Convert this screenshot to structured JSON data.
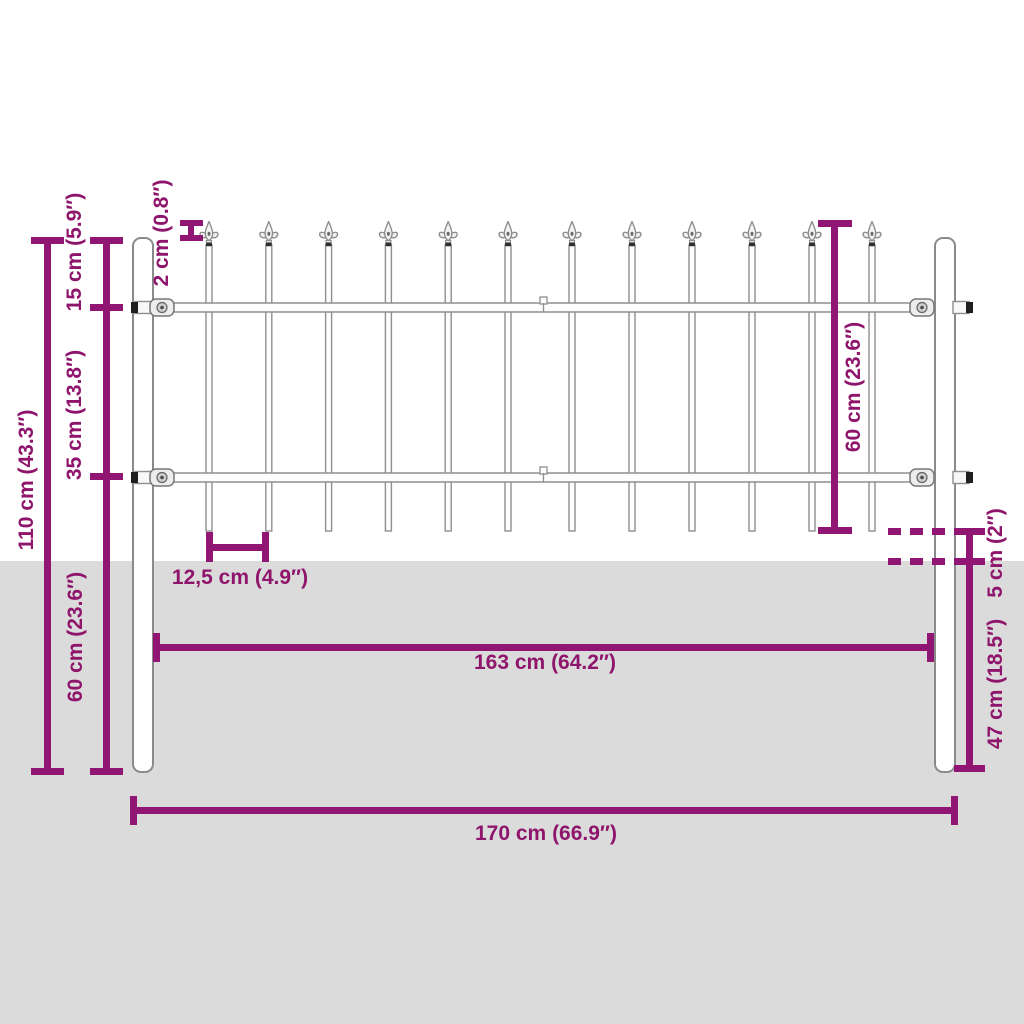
{
  "diagram": {
    "type": "product-dimensions",
    "subject": "garden fence panel with spear-top pickets and ground posts"
  },
  "dimensions": {
    "total_height": "110 cm (43.3″)",
    "top_section": "15 cm (5.9″)",
    "rail_spacing": "35 cm (13.8″)",
    "spear_offset": "2 cm (0.8″)",
    "post_below_panel": "60 cm (23.6″)",
    "panel_height": "60 cm (23.6″)",
    "picket_spacing": "12,5 cm (4.9″)",
    "panel_width": "163 cm (64.2″)",
    "ground_clearance": "5 cm (2″)",
    "embed_depth": "47 cm (18.5″)",
    "total_width": "170 cm (66.9″)"
  },
  "fence": {
    "posts": 2,
    "panels": 2,
    "pickets_per_panel": 6,
    "rails": 2,
    "finial_style": "spear"
  },
  "colors": {
    "dimension_line": "#911573",
    "dimension_text": "#8E156B",
    "ground": "#DBDBDB",
    "fence_outline": "#8F8F8F",
    "background": "#FFFFFF"
  }
}
